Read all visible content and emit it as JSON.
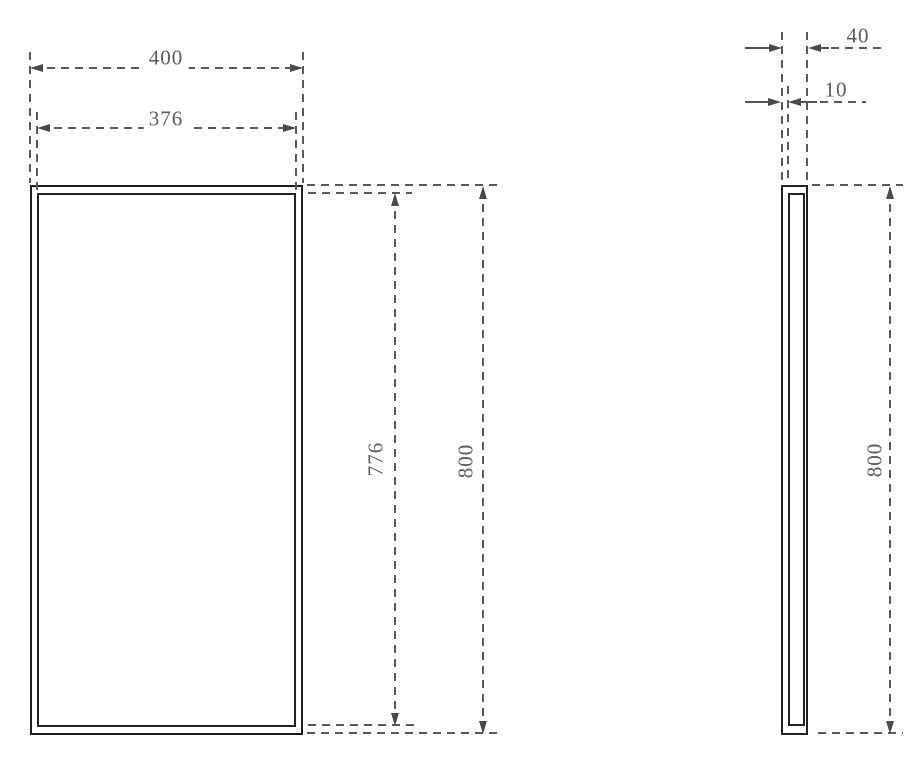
{
  "drawing": {
    "front_view": {
      "outer_width": "400",
      "inner_width": "376",
      "inner_height": "776",
      "outer_height": "800"
    },
    "side_view": {
      "depth": "40",
      "panel_thickness": "10",
      "height": "800"
    },
    "colors": {
      "solid_line": "#1e1e1e",
      "dimension_line": "#5a5a5a",
      "text": "#5c5c5c",
      "background": "#ffffff"
    }
  }
}
